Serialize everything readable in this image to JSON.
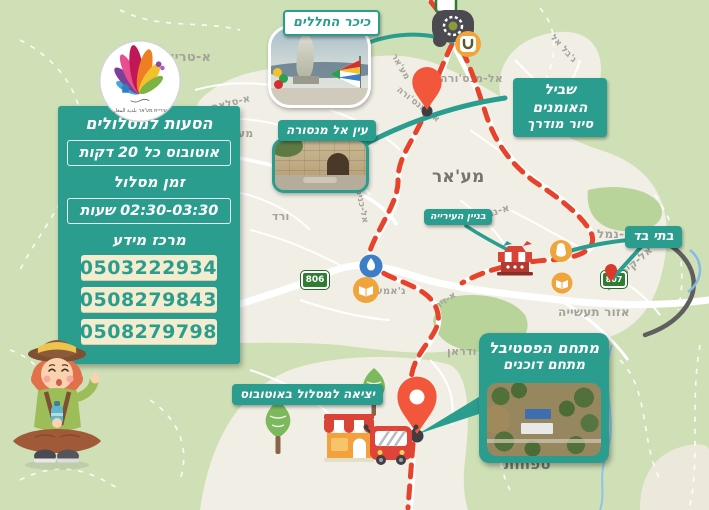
{
  "logo": {
    "municipality": "עיריית מע'אר بلدية المغار"
  },
  "shuttle_panel": {
    "title": "הסעות למסלולים",
    "bus_frequency": "אוטובוס כל 20 דקות",
    "route_time_label": "זמן מסלול",
    "route_duration": "02:30-03:30 שעות",
    "info_center": "מרכז מידע",
    "phones": [
      "0503222934",
      "0508279843",
      "0508279798"
    ]
  },
  "callouts": {
    "memorial_square": "כיכר החללים",
    "ein_al_mansura": "עין אל מנסורה",
    "artists_trail_line1": "שביל האומנים",
    "artists_trail_line2": "סיור מודרך",
    "city_hall": "בניין העירייה",
    "olive_presses": "בתי בד",
    "festival_line1": "מתחם הפסטיבל",
    "festival_line2": "מתחם דוכנים",
    "bus_departure": "יציאה למסלול באוטובוס"
  },
  "map_labels": {
    "atarik": "א-טריק",
    "asalam": "א-סלאם",
    "maarav": "מערב",
    "almansura": "אל-מנס'ורה",
    "city": "מע'אר",
    "vered": "ורד",
    "alkenisa": "אל-כניסה",
    "mansura_rd": "אל-מנס'ורה",
    "maghar_rd": "מע'אר",
    "jabal": "ג'בל אל",
    "anakhil": "א-נח'יל",
    "abu_anamal": "אבו א-נמל",
    "alqisarya": "אל-קיסרייה",
    "industrial": "אזור תעשייה",
    "jame": "ג'אמע",
    "azeit": "א-זית",
    "tfahot": "טפחות",
    "wadran": "ודראן"
  },
  "road_badges": {
    "b806": "806",
    "b807": "807"
  },
  "colors": {
    "teal": "#2a9d8f",
    "route_red": "#e7432c",
    "cream": "#f3ecce",
    "badge_green": "#2e7d32"
  }
}
